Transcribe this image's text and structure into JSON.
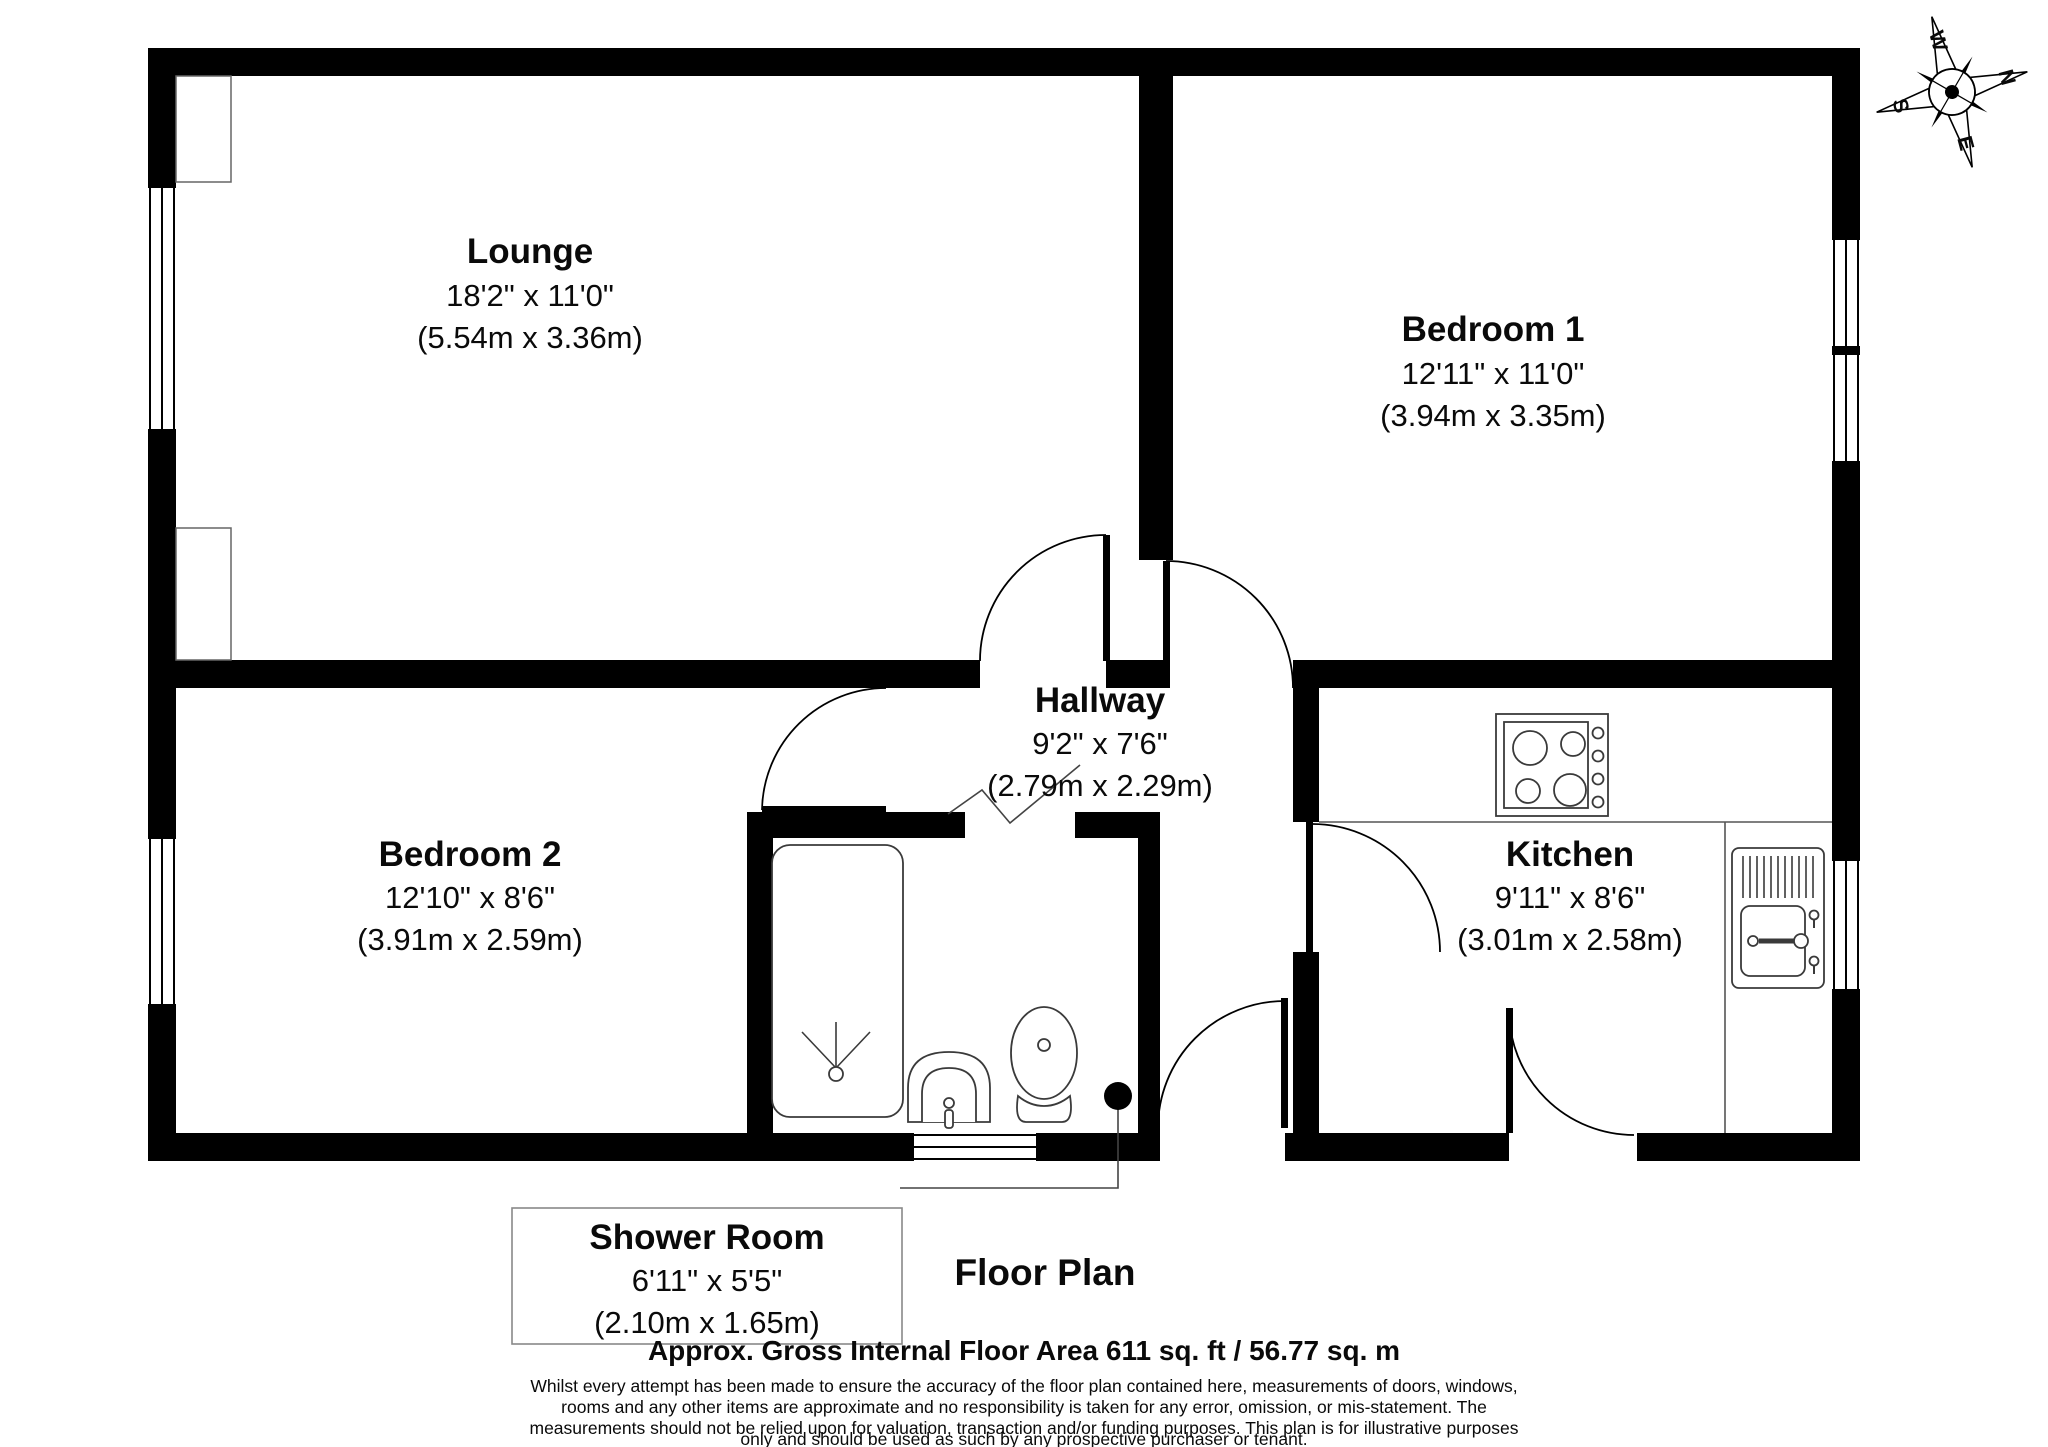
{
  "title": "Floor Plan",
  "rooms": [
    {
      "name": "Lounge",
      "imperial": "18'2\" x 11'0\"",
      "metric": "(5.54m x 3.36m)"
    },
    {
      "name": "Bedroom 1",
      "imperial": "12'11\" x 11'0\"",
      "metric": "(3.94m x 3.35m)"
    },
    {
      "name": "Hallway",
      "imperial": "9'2\" x 7'6\"",
      "metric": "(2.79m x 2.29m)"
    },
    {
      "name": "Bedroom 2",
      "imperial": "12'10\" x 8'6\"",
      "metric": "(3.91m x 2.59m)"
    },
    {
      "name": "Kitchen",
      "imperial": "9'11\" x 8'6\"",
      "metric": "(3.01m x 2.58m)"
    },
    {
      "name": "Shower Room",
      "imperial": "6'11\" x 5'5\"",
      "metric": "(2.10m x 1.65m)"
    }
  ],
  "compass": {
    "n": "N",
    "e": "E",
    "s": "S",
    "w": "W"
  },
  "footer": {
    "area_line": "Approx. Gross Internal Floor Area 611 sq. ft / 56.77 sq. m",
    "disclaimer_lines": [
      "Whilst every attempt has been made to ensure the accuracy of the floor plan contained here, measurements of doors, windows,",
      "rooms and any other items are approximate and no responsibility is taken for any error, omission, or mis-statement. The",
      "measurements should not be relied upon for valuation, transaction and/or funding purposes. This plan is for illustrative purposes",
      "only and should be used as such by any prospective purchaser or tenant."
    ]
  },
  "colors": {
    "wall": "#000000",
    "background": "#ffffff",
    "leader": "#444444"
  }
}
